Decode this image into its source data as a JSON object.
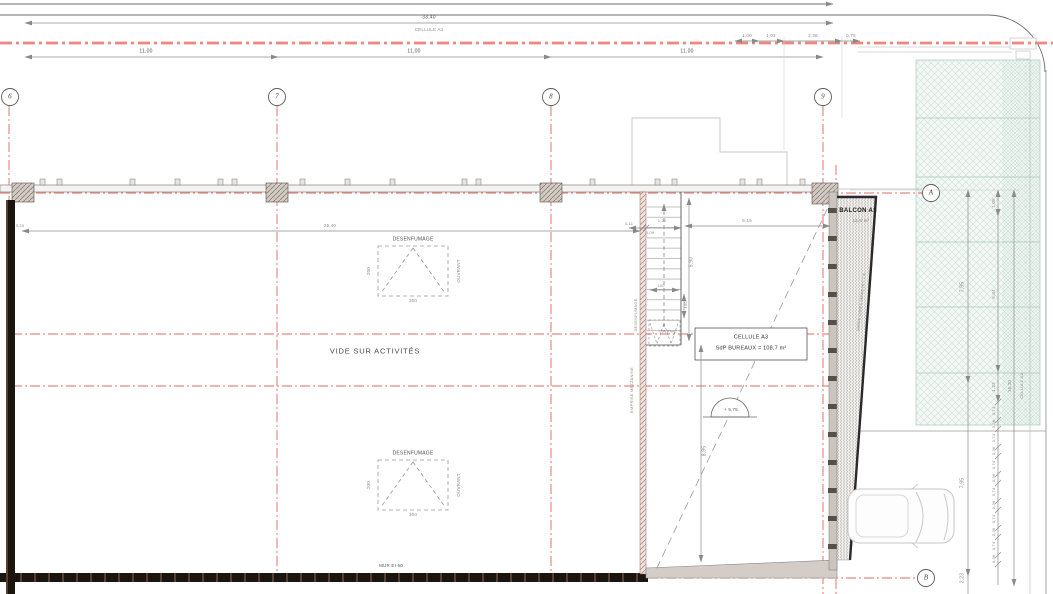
{
  "top": {
    "dim_overall": "33,40",
    "cellule": "CELLULE A3",
    "small_dims": [
      "1,00",
      "1,02",
      "2,38",
      "0,75"
    ],
    "bay_dims": [
      "11,00",
      "11,00",
      "11,00"
    ]
  },
  "grid": {
    "cols": [
      "6",
      "7",
      "8",
      "9"
    ],
    "rows": [
      "A",
      "B"
    ]
  },
  "hall": {
    "vide": "VIDE SUR ACTIVITÉS",
    "mur": "MUR EI 60",
    "dim_width": "25,40",
    "dim_wall": "0,20",
    "mezzanine": "EMPRISE MEZZANINE"
  },
  "vent": {
    "title": "DESENFUMAGE",
    "ouvrant": "OUVRANT",
    "h": "200",
    "w": "300"
  },
  "stair": {
    "desenfumage": "DESENFUMAGE",
    "ouvrant": "OUVRANT",
    "d1": "0,11",
    "d2": "1,20",
    "d3": "0,09",
    "d4": "6,15",
    "d5": "5,90",
    "d6": "100",
    "d7": "100",
    "d8": "8,95"
  },
  "cell": {
    "line1": "CELLULE A3",
    "line2": "SdP BUREAUX = 108,7 m²",
    "level": "+ 5,75"
  },
  "balcony": {
    "title": "BALCON A3",
    "area": "15,6 m²",
    "rail": "GARDE-CORPS SERRE Ht = 1 m"
  },
  "right": {
    "d_795a": "7,95",
    "d_795b": "7,95",
    "d_223": "2,23",
    "d_108": "1,08",
    "d_644": "6,44",
    "d_123": "1,23",
    "d_1630": "16,30",
    "cellule": "CELLULE A3",
    "alt": [
      "0,74",
      "0,36",
      "0,74",
      "0,36",
      "0,74",
      "0,36",
      "0,74",
      "0,36",
      "0,74",
      "0,36",
      "0,74",
      "0,36"
    ]
  },
  "colors": {
    "axis_red": "#e4685c",
    "band_pink": "#f0867c",
    "wall_dark": "#1b150f",
    "green_hatch": "#cee2d9",
    "dim_gray": "#8a8a8a",
    "hatch_fill": "#d2cac3"
  }
}
